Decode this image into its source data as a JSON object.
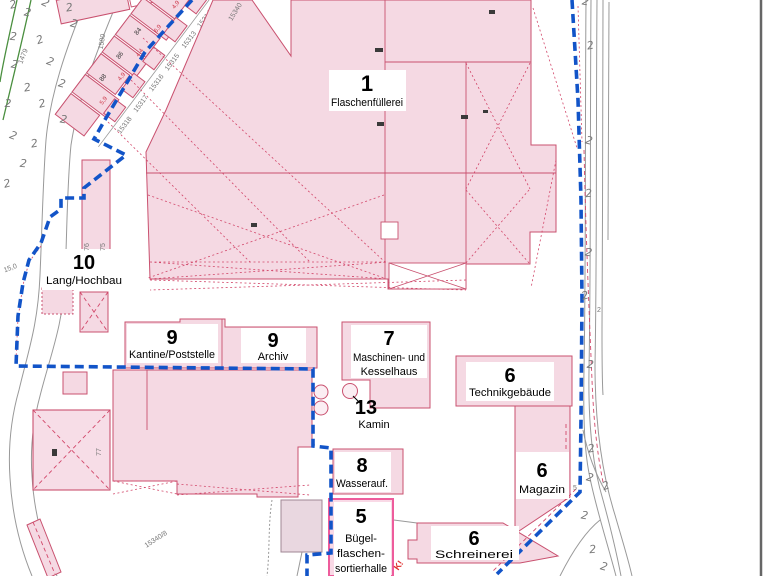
{
  "plan": {
    "buildings": {
      "flaschenfuellerei": {
        "number": "1",
        "name": "Flaschenfüllerei"
      },
      "lang_hochbau": {
        "number": "10",
        "name": "Lang/Hochbau"
      },
      "kantine_poststelle": {
        "number": "9",
        "name": "Kantine/Poststelle"
      },
      "archiv": {
        "number": "9",
        "name": "Archiv"
      },
      "maschinen_kesselhaus": {
        "number": "7",
        "name_line1": "Maschinen- und",
        "name_line2": "Kesselhaus"
      },
      "technikgebaeude": {
        "number": "6",
        "name": "Technikgebäude"
      },
      "kamin": {
        "number": "13",
        "name": "Kamin"
      },
      "wasseraufbereitung": {
        "number": "8",
        "name": "Wasserauf."
      },
      "magazin": {
        "number": "6",
        "name": "Magazin"
      },
      "buegelflaschensortierhalle": {
        "number": "5",
        "name_line1": "Bügel-",
        "name_line2": "flaschen-",
        "name_line3": "sortierhalle"
      },
      "schreinerei": {
        "number": "6",
        "name": "Schreinerei"
      }
    },
    "small_labels": [
      {
        "text": "1479",
        "x": 25,
        "y": 57,
        "rot": -68,
        "cls": "tiny"
      },
      {
        "text": "1580",
        "x": 104,
        "y": 42,
        "rot": -80,
        "cls": "tiny"
      },
      {
        "text": "15340",
        "x": 237,
        "y": 13,
        "rot": -58,
        "cls": "tiny"
      },
      {
        "text": "15,0",
        "x": 11,
        "y": 270,
        "rot": -20,
        "cls": "tiny"
      },
      {
        "text": "15340/8",
        "x": 157,
        "y": 541,
        "rot": -33,
        "cls": "tiny"
      },
      {
        "text": "5",
        "x": 575,
        "y": 490,
        "rot": 0,
        "cls": "tiny"
      },
      {
        "text": "2",
        "x": 599,
        "y": 312,
        "rot": 0,
        "cls": "tiny"
      },
      {
        "text": "77",
        "x": 101,
        "y": 452,
        "rot": -90,
        "cls": "tiny"
      },
      {
        "text": "76",
        "x": 89,
        "y": 247,
        "rot": -90,
        "cls": "tiny"
      },
      {
        "text": "75",
        "x": 105,
        "y": 247,
        "rot": -90,
        "cls": "tiny"
      },
      {
        "text": "K!",
        "x": 401,
        "y": 567,
        "rot": -55,
        "cls": "redfrag"
      }
    ],
    "strip": {
      "houses_back": [
        {
          "x": 0,
          "w": 26,
          "h": 36
        },
        {
          "x": 28,
          "w": 22,
          "h": 42
        },
        {
          "x": 52,
          "w": 24,
          "h": 36
        },
        {
          "x": 78,
          "w": 20,
          "h": 42
        },
        {
          "x": 100,
          "w": 24,
          "h": 38
        },
        {
          "x": 126,
          "w": 20,
          "h": 44
        },
        {
          "x": 148,
          "w": 26,
          "h": 38
        },
        {
          "x": 176,
          "w": 20,
          "h": 42
        },
        {
          "x": 198,
          "w": 17,
          "h": 36
        }
      ],
      "houses_front": [
        {
          "x": 30,
          "w": 18
        },
        {
          "x": 60,
          "w": 20
        },
        {
          "x": 95,
          "w": 18
        },
        {
          "x": 130,
          "w": 20
        },
        {
          "x": 165,
          "w": 18
        },
        {
          "x": 195,
          "w": 16
        }
      ],
      "parcel_numbers": [
        {
          "text": "15318",
          "x": 33
        },
        {
          "text": "15317",
          "x": 60
        },
        {
          "text": "15316",
          "x": 86
        },
        {
          "text": "15315",
          "x": 112
        },
        {
          "text": "15313",
          "x": 140
        },
        {
          "text": "15314",
          "x": 166
        },
        {
          "text": "15312",
          "x": 192
        }
      ],
      "measures": [
        {
          "text": "5,9",
          "x": 40
        },
        {
          "text": "4,9",
          "x": 70
        },
        {
          "text": "4,4",
          "x": 100
        },
        {
          "text": "6,9",
          "x": 130
        },
        {
          "text": "4,9",
          "x": 160
        }
      ],
      "house_numbers": [
        {
          "text": "88",
          "x": 58
        },
        {
          "text": "86",
          "x": 86
        },
        {
          "text": "84",
          "x": 116
        }
      ]
    },
    "trees": [
      {
        "x": 14,
        "y": 8,
        "r": -15
      },
      {
        "x": 27,
        "y": 16,
        "r": 10
      },
      {
        "x": 44,
        "y": 6,
        "r": 25
      },
      {
        "x": 70,
        "y": 11,
        "r": -10
      },
      {
        "x": 73,
        "y": 27,
        "r": 15
      },
      {
        "x": 13,
        "y": 40,
        "r": 5
      },
      {
        "x": 41,
        "y": 43,
        "r": -20
      },
      {
        "x": 14,
        "y": 68,
        "r": 10
      },
      {
        "x": 49,
        "y": 65,
        "r": 20
      },
      {
        "x": 28,
        "y": 91,
        "r": -10
      },
      {
        "x": 61,
        "y": 87,
        "r": 15
      },
      {
        "x": 8,
        "y": 107,
        "r": 0
      },
      {
        "x": 43,
        "y": 107,
        "r": -15
      },
      {
        "x": 63,
        "y": 123,
        "r": 10
      },
      {
        "x": 12,
        "y": 139,
        "r": 20
      },
      {
        "x": 35,
        "y": 147,
        "r": -10
      },
      {
        "x": 23,
        "y": 167,
        "r": 5
      },
      {
        "x": 8,
        "y": 187,
        "r": -15
      },
      {
        "x": 585,
        "y": 5,
        "r": 10
      },
      {
        "x": 591,
        "y": 49,
        "r": -10
      },
      {
        "x": 588,
        "y": 144,
        "r": 15
      },
      {
        "x": 589,
        "y": 197,
        "r": -5
      },
      {
        "x": 588,
        "y": 256,
        "r": 10
      },
      {
        "x": 586,
        "y": 299,
        "r": -15
      },
      {
        "x": 590,
        "y": 368,
        "r": 5
      },
      {
        "x": 592,
        "y": 452,
        "r": -10
      },
      {
        "x": 589,
        "y": 481,
        "r": 15
      },
      {
        "x": 607,
        "y": 489,
        "r": -20
      },
      {
        "x": 584,
        "y": 519,
        "r": 10
      },
      {
        "x": 593,
        "y": 553,
        "r": -5
      },
      {
        "x": 603,
        "y": 570,
        "r": 15
      }
    ],
    "marks": [
      {
        "x": 375,
        "y": 48,
        "w": 8,
        "h": 4
      },
      {
        "x": 489,
        "y": 10,
        "w": 6,
        "h": 4
      },
      {
        "x": 461,
        "y": 115,
        "w": 7,
        "h": 4
      },
      {
        "x": 483,
        "y": 110,
        "w": 5,
        "h": 3
      },
      {
        "x": 377,
        "y": 122,
        "w": 7,
        "h": 4
      },
      {
        "x": 251,
        "y": 223,
        "w": 6,
        "h": 4
      },
      {
        "x": 52,
        "y": 449,
        "w": 5,
        "h": 7
      }
    ],
    "colors": {
      "boundary_blue": "#1254c8",
      "building_fill": "#f5d9e3",
      "building_stroke": "#c9516f",
      "highlight_pink": "#ee5c9c",
      "road_gray": "#999999",
      "vegetation_green": "#4a8f3f",
      "label_text": "#000000"
    }
  }
}
